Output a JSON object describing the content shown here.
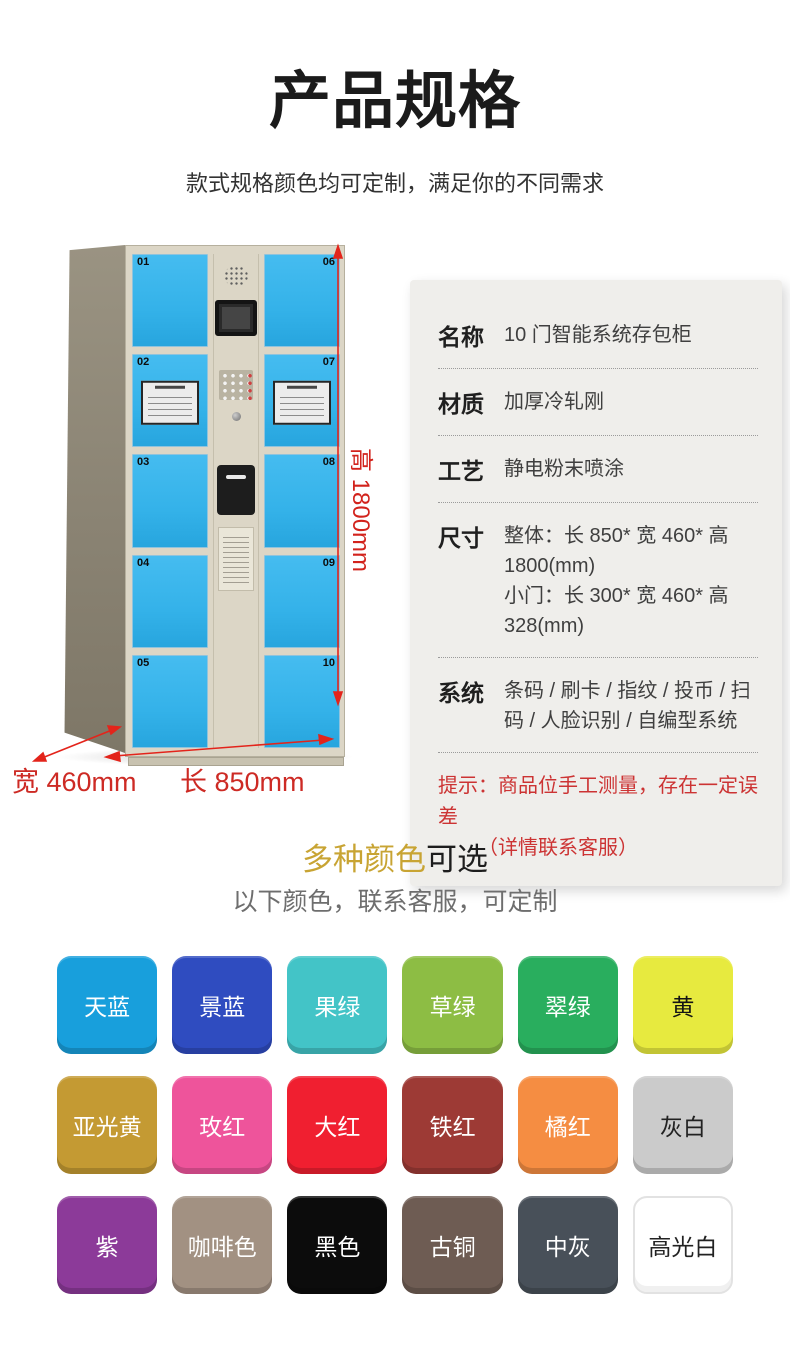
{
  "page": {
    "title": "产品规格",
    "subtitle": "款式规格颜色均可定制，满足你的不同需求"
  },
  "locker": {
    "left_door_numbers": [
      "01",
      "02",
      "03",
      "04",
      "05"
    ],
    "right_door_numbers": [
      "06",
      "07",
      "08",
      "09",
      "10"
    ],
    "sticker_doors": [
      "02",
      "07"
    ],
    "door_color": "#34b2e9",
    "body_color": "#dcd6c6",
    "dimensions": {
      "height_label": "高 1800mm",
      "width_label": "宽 460mm",
      "length_label": "长 850mm",
      "arrow_color": "#e3241b"
    }
  },
  "spec": {
    "rows": [
      {
        "label": "名称",
        "value": "10 门智能系统存包柜"
      },
      {
        "label": "材质",
        "value": "加厚冷轧刚"
      },
      {
        "label": "工艺",
        "value": "静电粉末喷涂"
      },
      {
        "label": "尺寸",
        "value_line1": "整体：长 850* 宽 460* 高 1800(mm)",
        "value_line2": "小门：长 300* 宽 460* 高 328(mm)"
      },
      {
        "label": "系统",
        "value": "条码 / 刷卡 / 指纹 / 投币 / 扫码 / 人脸识别 / 自编型系统"
      }
    ],
    "note_line1": "提示：商品位手工测量，存在一定误差",
    "note_line2": "（详情联系客服）",
    "note_color": "#cc3333"
  },
  "colors_section": {
    "heading_highlight": "多种颜色",
    "heading_rest": "可选",
    "highlight_color": "#c8a433",
    "subtitle": "以下颜色，联系客服，可定制",
    "swatches": [
      {
        "label": "天蓝",
        "bg": "#189fdc",
        "text": "#ffffff"
      },
      {
        "label": "景蓝",
        "bg": "#2f4cc0",
        "text": "#ffffff"
      },
      {
        "label": "果绿",
        "bg": "#43c4c7",
        "text": "#ffffff"
      },
      {
        "label": "草绿",
        "bg": "#8dbd44",
        "text": "#ffffff"
      },
      {
        "label": "翠绿",
        "bg": "#29ae5e",
        "text": "#ffffff"
      },
      {
        "label": "黄",
        "bg": "#e7ea3f",
        "text": "#141414"
      },
      {
        "label": "亚光黄",
        "bg": "#c49a33",
        "text": "#ffffff"
      },
      {
        "label": "玫红",
        "bg": "#ee549b",
        "text": "#ffffff"
      },
      {
        "label": "大红",
        "bg": "#f01f30",
        "text": "#ffffff"
      },
      {
        "label": "铁红",
        "bg": "#9d3a35",
        "text": "#ffffff"
      },
      {
        "label": "橘红",
        "bg": "#f58d42",
        "text": "#ffffff"
      },
      {
        "label": "灰白",
        "bg": "#cbcbcb",
        "text": "#222222"
      },
      {
        "label": "紫",
        "bg": "#8c3a99",
        "text": "#ffffff"
      },
      {
        "label": "咖啡色",
        "bg": "#a29182",
        "text": "#ffffff"
      },
      {
        "label": "黑色",
        "bg": "#0c0c0c",
        "text": "#ffffff"
      },
      {
        "label": "古铜",
        "bg": "#6e5c53",
        "text": "#ffffff"
      },
      {
        "label": "中灰",
        "bg": "#485059",
        "text": "#ffffff"
      },
      {
        "label": "高光白",
        "bg": "#ffffff",
        "text": "#222222"
      }
    ]
  }
}
